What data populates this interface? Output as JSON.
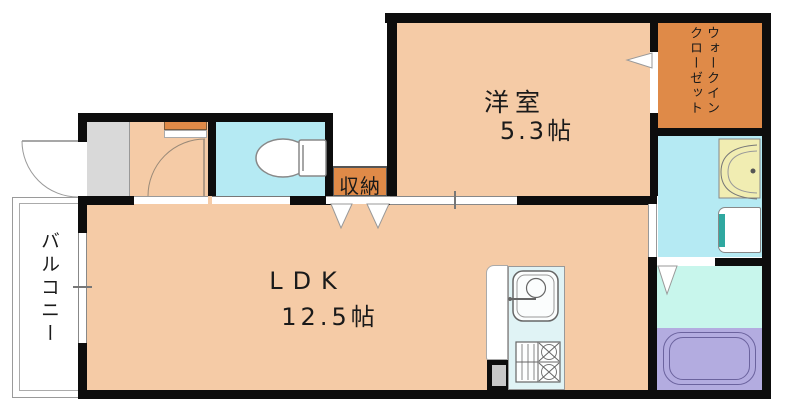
{
  "floorplan": {
    "type": "japanese-apartment-floor-plan",
    "rooms": {
      "western_room": {
        "name": "洋室",
        "size": "5.3帖"
      },
      "ldk": {
        "name": "LDK",
        "size": "12.5帖"
      },
      "storage": {
        "label": "収納"
      },
      "walk_in_closet": {
        "label_line1": "ウォークイン",
        "label_line2": "クローゼット"
      },
      "balcony": {
        "label": "バルコニー"
      },
      "entry": {
        "label": ""
      },
      "toilet": {
        "label": ""
      },
      "washroom": {
        "label": ""
      },
      "bathroom": {
        "label": ""
      }
    },
    "fixtures": [
      "toilet-icon",
      "kitchen-sink-icon",
      "gas-stove-icon",
      "bathtub-icon",
      "washbasin-icon",
      "washing-machine-space-icon",
      "entry-swing-door-icon",
      "room-swing-door-icon",
      "sliding-door-icon",
      "folding-door-triangles-icon"
    ],
    "colors": {
      "room_peach": "#F5CBA6",
      "closet_orange": "#DF8A48",
      "water_cyan": "#B5EAF3",
      "bath_cyan": "#C8F6EC",
      "kitchen_counter_cyan": "#E0F3F5",
      "bathtub_purple": "#B3ACE0",
      "entry_gray": "#D9D9D9",
      "washer_teal": "#2FA8A0",
      "washbasin_yellow": "#F1EDB2",
      "wall_black": "#0D0D0D"
    }
  }
}
